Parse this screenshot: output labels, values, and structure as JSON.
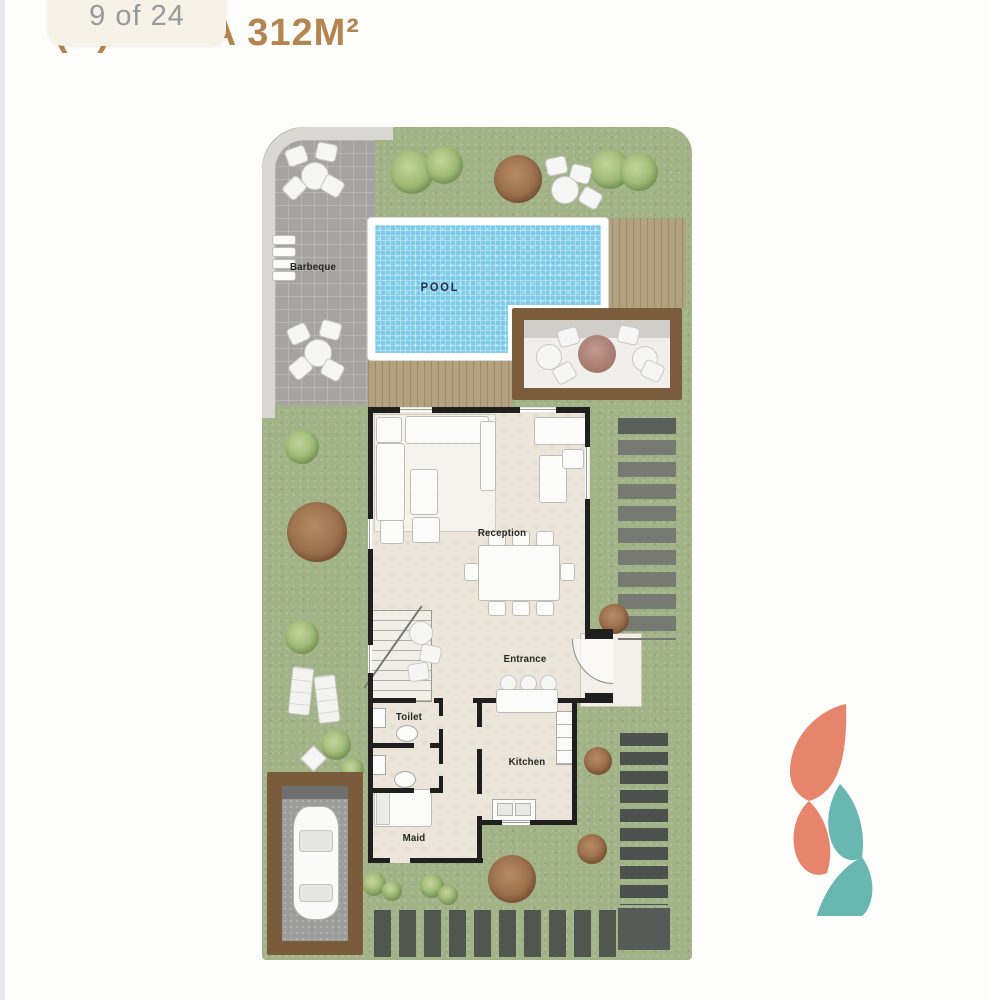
{
  "header": {
    "pager": "9 of 24",
    "title": "(B) VILLA 312M²"
  },
  "plan": {
    "labels": {
      "barbeque": "Barbeque",
      "pool": "POOL",
      "reception": "Reception",
      "entrance": "Entrance",
      "toilet": "Toilet",
      "kitchen": "Kitchen",
      "maid": "Maid"
    }
  },
  "colors": {
    "title_text": "#b5854f",
    "pager_text": "#97999b",
    "badge_bg": "#f6f2e7",
    "grass": "#a3b388",
    "pool_water": "#7ccbe8",
    "wood_deck": "#b3a27f",
    "pergola_wood": "#7b5c3c",
    "paving_gray": "#a5a4a2",
    "wall_black": "#1f1f1f",
    "floor_cream": "#ece6da",
    "stone_dark": "#4c514d",
    "stone_light": "#767a72",
    "logo_coral": "#e6856c",
    "logo_teal": "#69b7b1"
  }
}
